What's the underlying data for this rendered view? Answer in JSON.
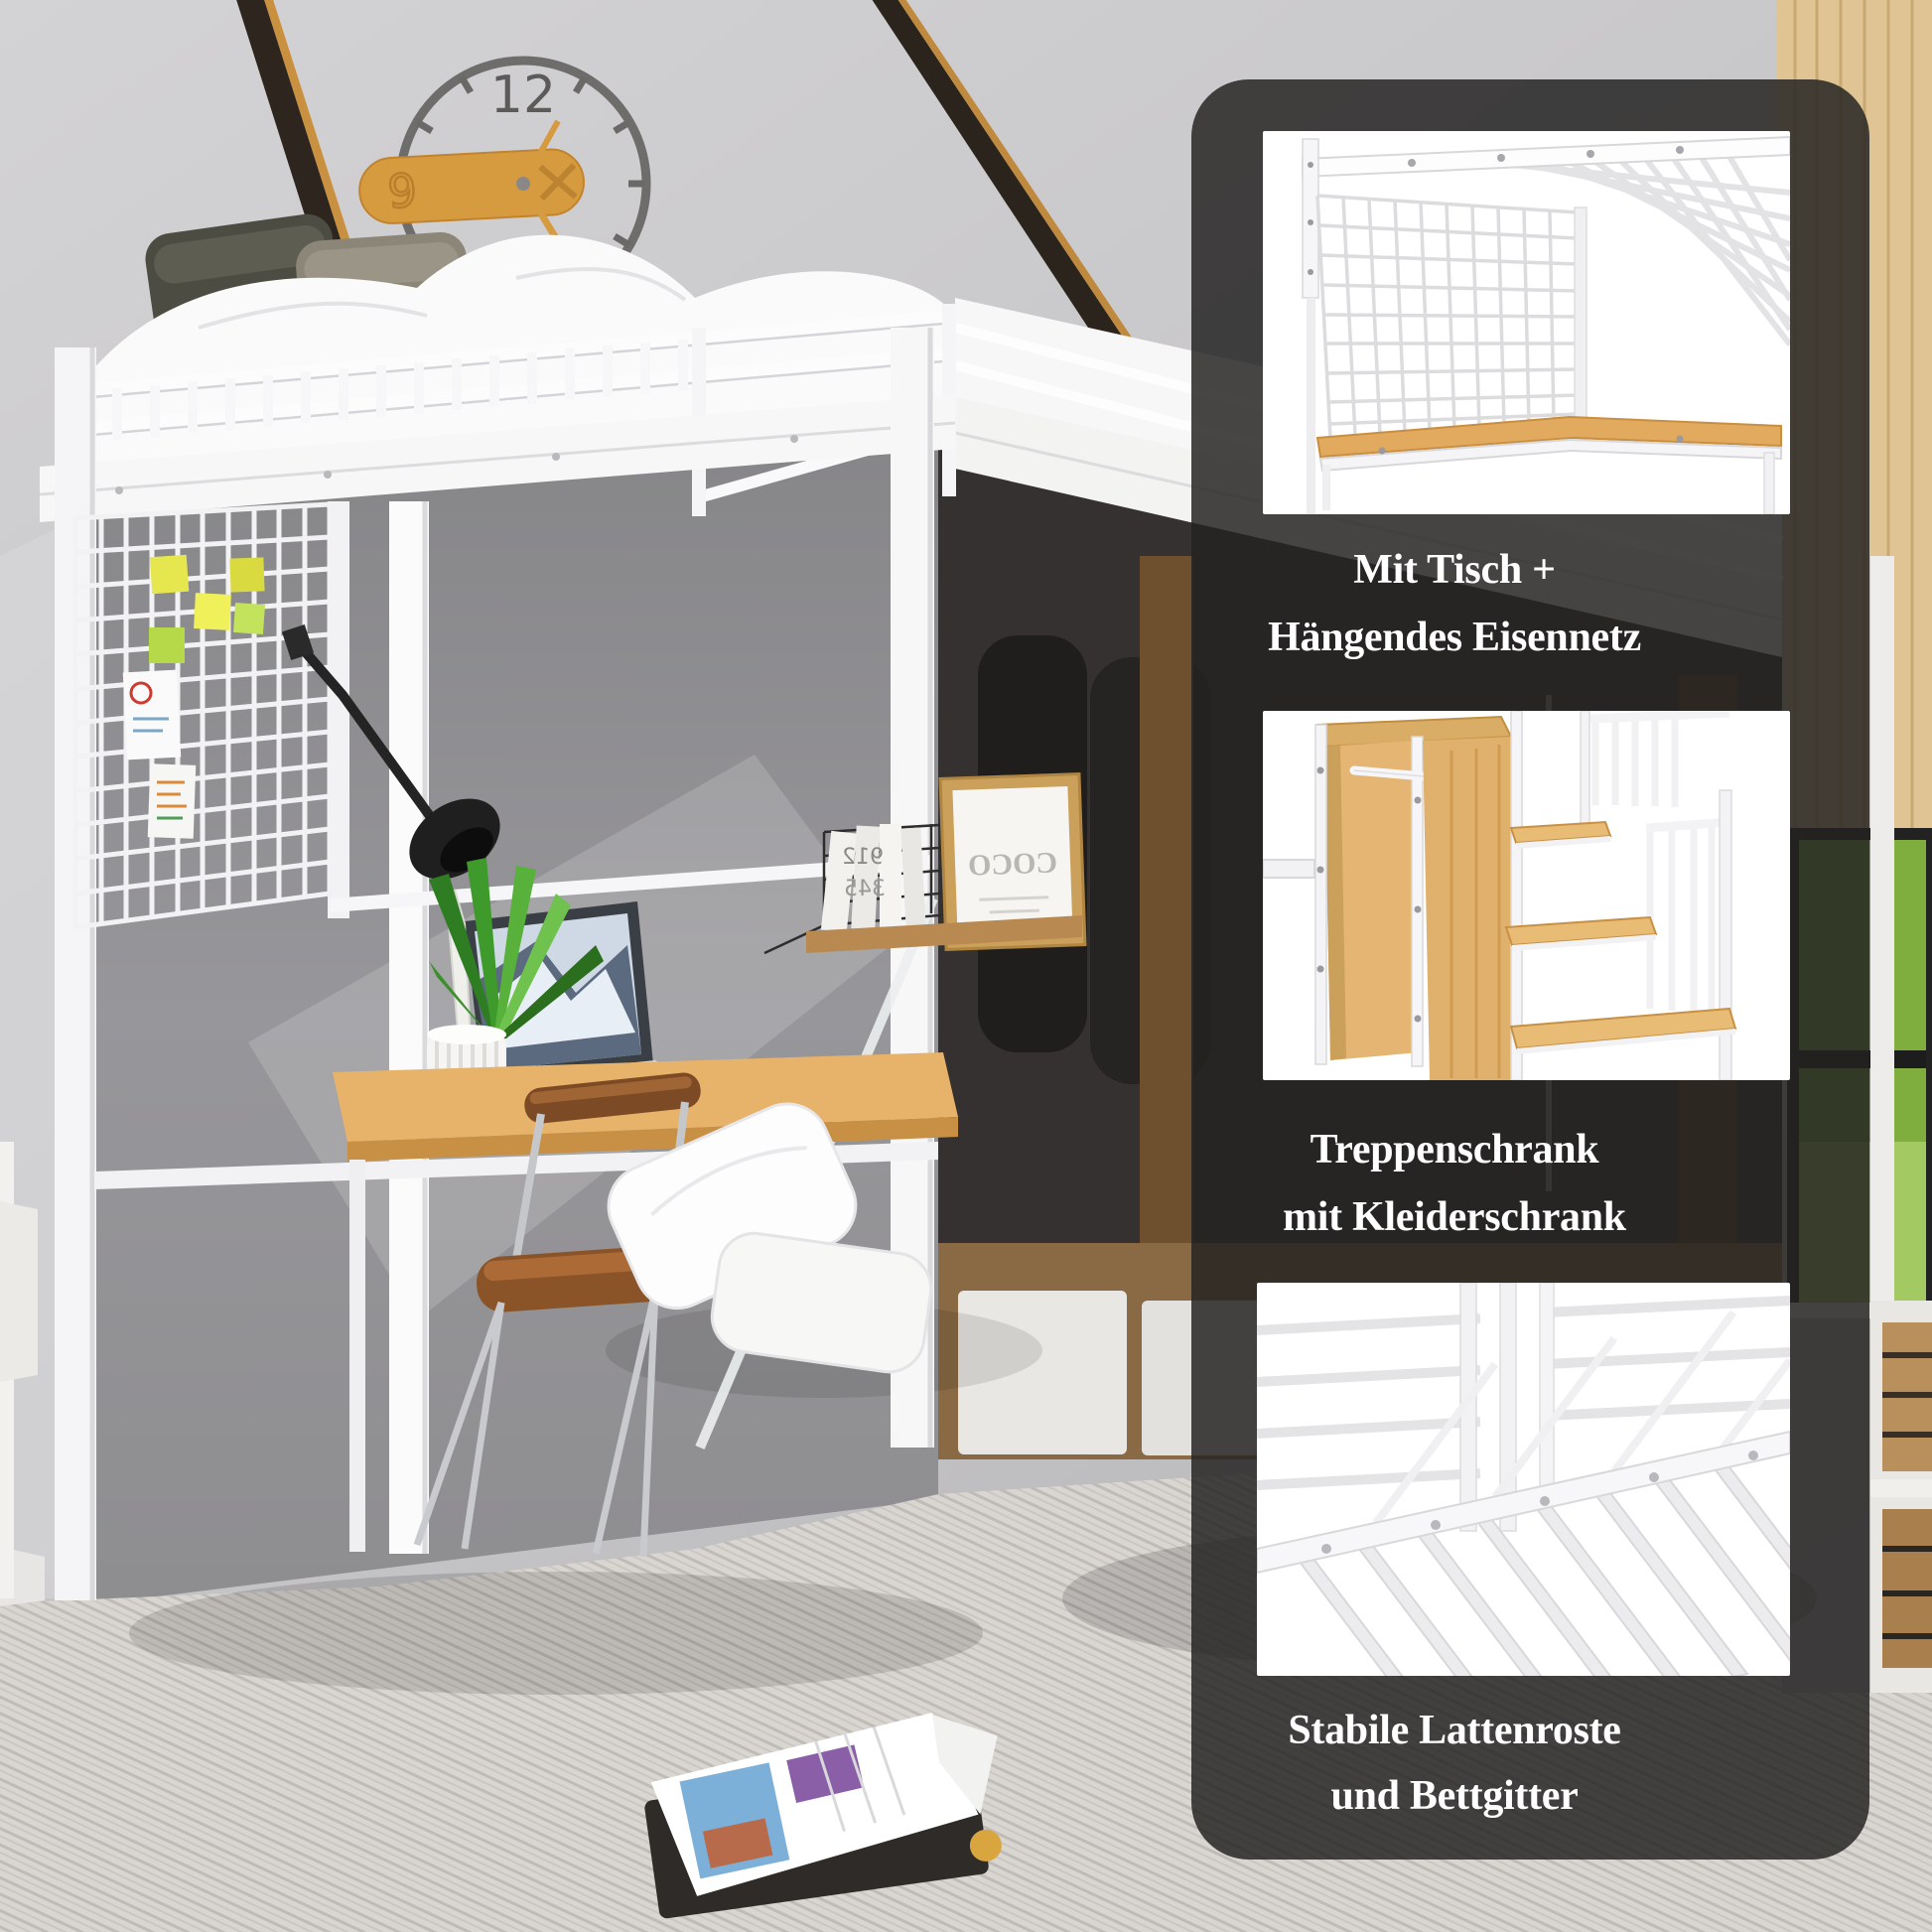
{
  "panel": {
    "overlay_color": "rgba(36,34,33,0.84)",
    "text_color": "#ffffff",
    "features": [
      {
        "image_label": "bed-underside-with-table-and-hanging-net",
        "line1": "Mit Tisch +",
        "line2": "Hängendes Eisennetz"
      },
      {
        "image_label": "stair-storage-with-wardrobe",
        "line1": "Treppenschrank",
        "line2": "mit Kleiderschrank"
      },
      {
        "image_label": "metal-slats-and-guard-rails",
        "line1": "Stabile Lattenroste",
        "line2": "und Bettgitter"
      }
    ]
  },
  "photo": {
    "clock": {
      "top_numeral": "12",
      "plate_numeral": "9"
    },
    "poster_text": "COCO",
    "book_digits": [
      "912",
      "345"
    ]
  }
}
